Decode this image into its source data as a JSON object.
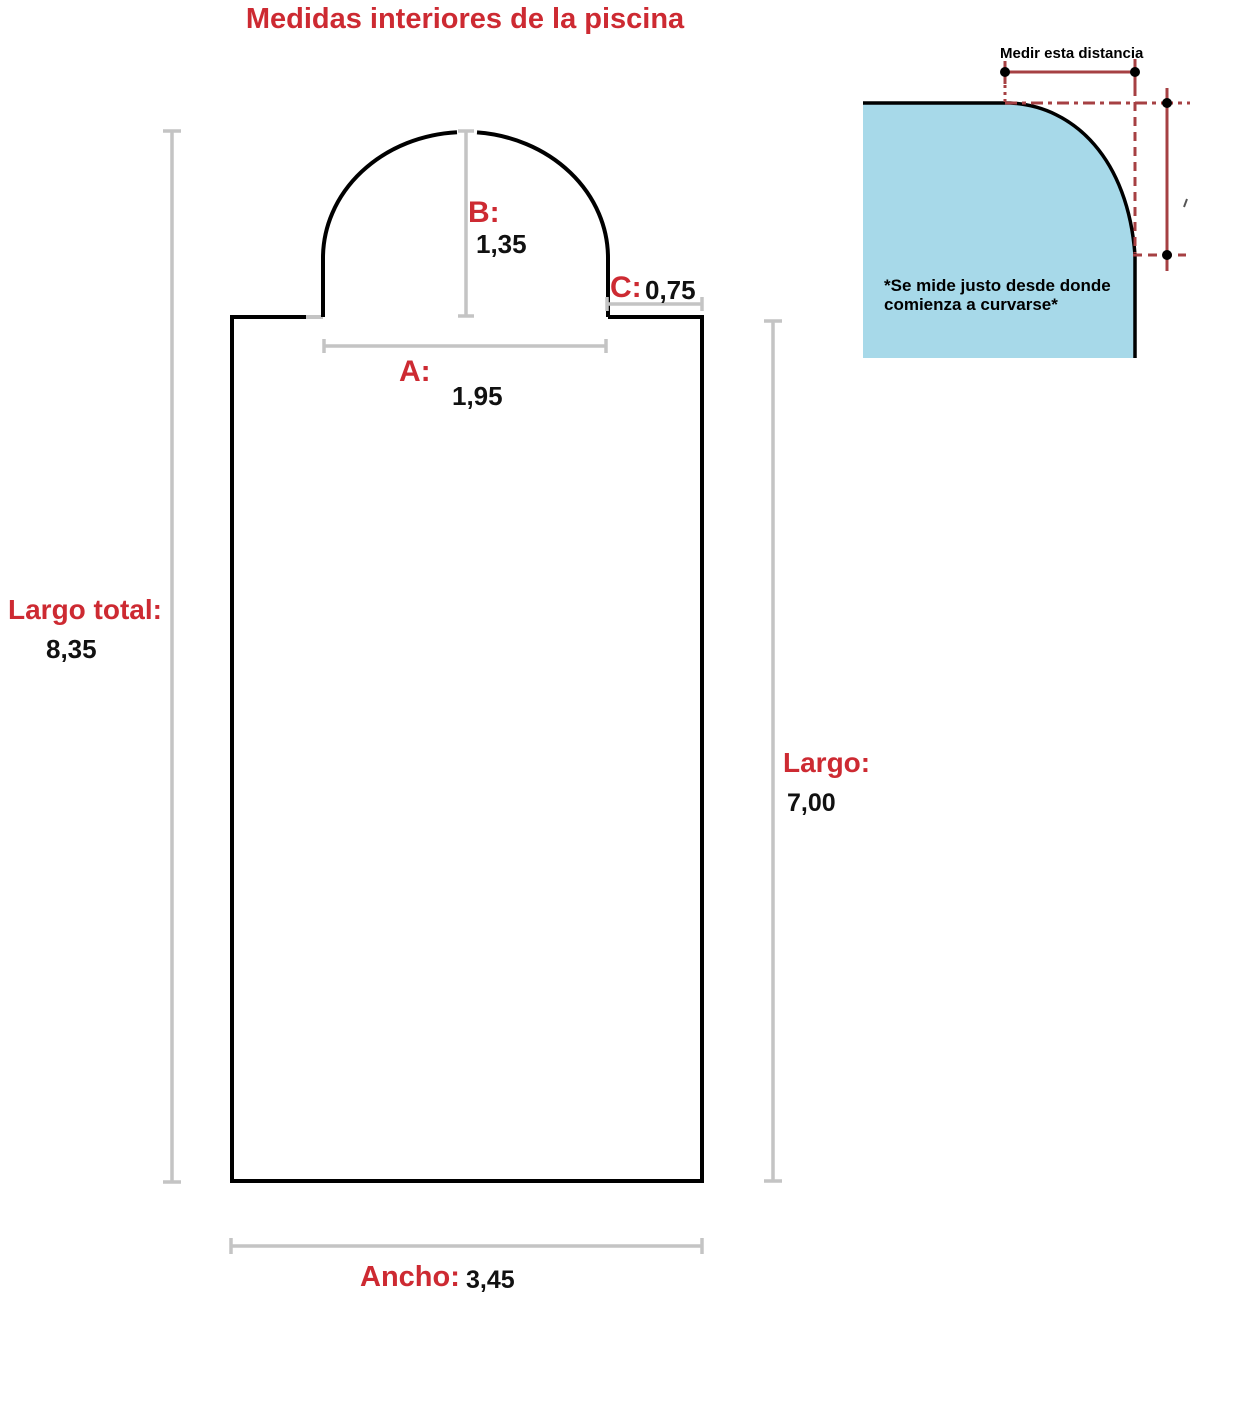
{
  "title": "Medidas interiores de la piscina",
  "colors": {
    "label_red": "#cd2a32",
    "value_black": "#111111",
    "outline_black": "#000000",
    "measure_gray": "#c4c4c4",
    "inset_line_red": "#a64043",
    "inset_fill_blue": "#a7d9e9"
  },
  "pool": {
    "dim_a": {
      "label": "A:",
      "value": "1,95"
    },
    "dim_b": {
      "label": "B:",
      "value": "1,35"
    },
    "dim_c": {
      "label": "C:",
      "value": "0,75"
    },
    "largo_total": {
      "label": "Largo total:",
      "value": "8,35"
    },
    "largo": {
      "label": "Largo:",
      "value": "7,00"
    },
    "ancho": {
      "label": "Ancho:",
      "value": "3,45"
    }
  },
  "inset": {
    "measure_label": "Medir esta distancia",
    "note_line1": "*Se mide justo desde donde",
    "note_line2": "comienza a curvarse*"
  }
}
